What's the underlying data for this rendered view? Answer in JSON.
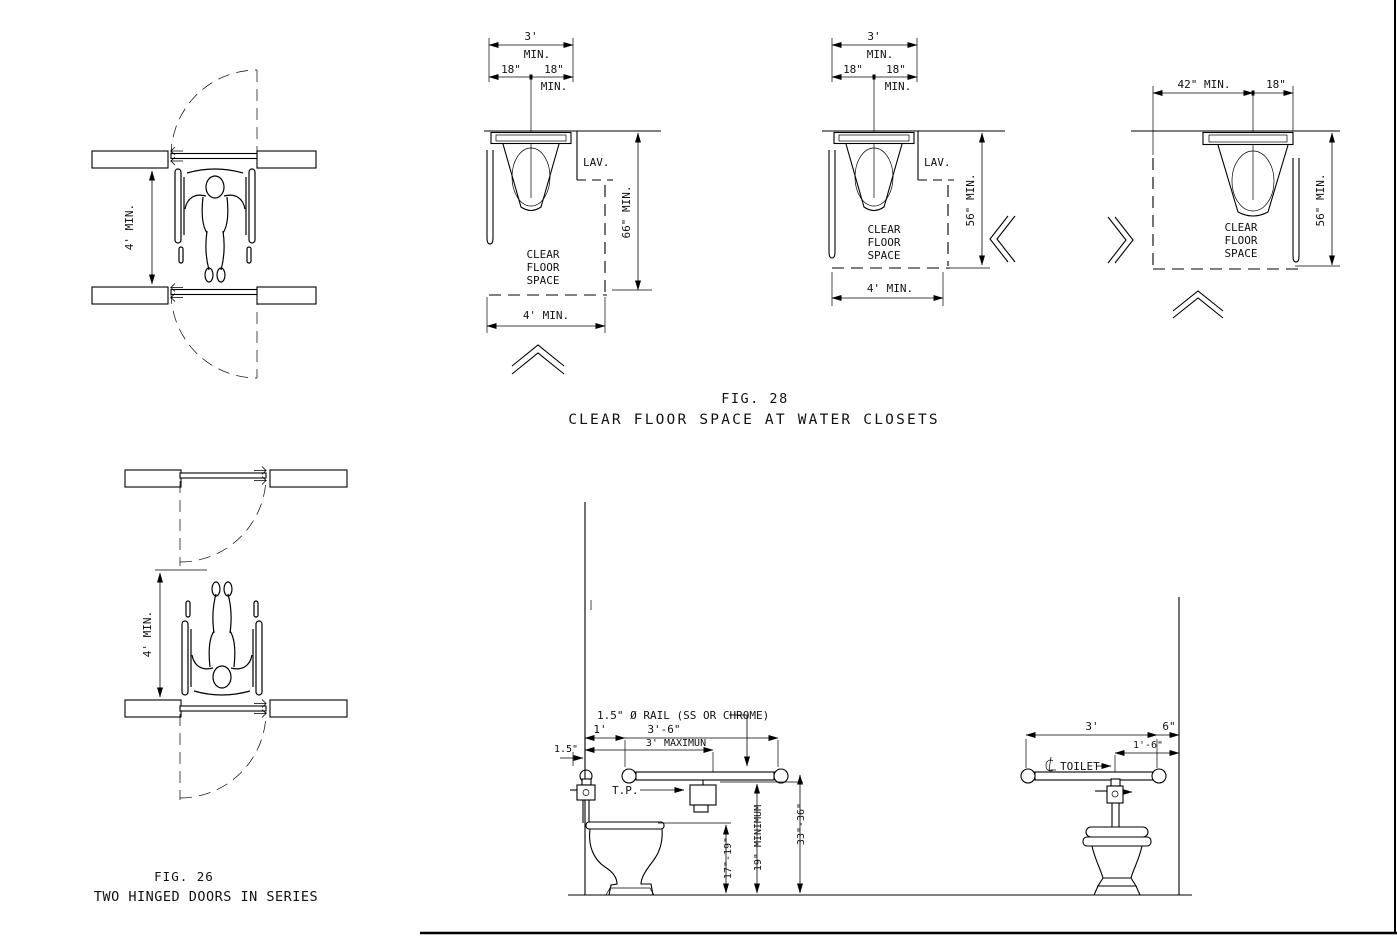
{
  "drawing": {
    "background": "#ffffff",
    "line_color": "#000000"
  },
  "fig26": {
    "label": "FIG. 26",
    "title": "TWO HINGED DOORS IN SERIES",
    "diagram1_dim": "4' MIN.",
    "diagram2_dim": "4' MIN."
  },
  "fig28": {
    "label": "FIG. 28",
    "title": "CLEAR FLOOR SPACE AT WATER CLOSETS",
    "wc1": {
      "width_dim": "3'",
      "width_min": "MIN.",
      "left_offset": "18\"",
      "right_offset": "18\"",
      "offset_min": "MIN.",
      "lav_label": "LAV.",
      "cfs": [
        "CLEAR",
        "FLOOR",
        "SPACE"
      ],
      "depth_dim": "66\" MIN.",
      "bottom_dim": "4' MIN."
    },
    "wc2": {
      "width_dim": "3'",
      "width_min": "MIN.",
      "left_offset": "18\"",
      "right_offset": "18\"",
      "offset_min": "MIN.",
      "lav_label": "LAV.",
      "cfs": [
        "CLEAR",
        "FLOOR",
        "SPACE"
      ],
      "depth_dim": "56\" MIN.",
      "bottom_dim": "4' MIN."
    },
    "wc3": {
      "width_dim": "42\" MIN.",
      "side_offset": "18\"",
      "cfs": [
        "CLEAR",
        "FLOOR",
        "SPACE"
      ],
      "depth_dim": "56\" MIN."
    }
  },
  "elevation": {
    "left": {
      "rail_label": "1.5\" Ø RAIL (SS OR CHROME)",
      "dim_1ft": "1'",
      "dim_3ft6": "3'-6\"",
      "dim_3max": "3' MAXIMUN",
      "dim_wall_gap": "1.5\"",
      "tp_label": "T.P.",
      "dim_seat_height": "17\"-19\"",
      "dim_tp_height": "19\" MINIMUM",
      "dim_rail_height": "33\"-36\""
    },
    "right": {
      "dim_bar": "3'",
      "dim_end": "6\"",
      "dim_cl": "1'-6\"",
      "toilet_cl_label": "TOILET"
    }
  }
}
